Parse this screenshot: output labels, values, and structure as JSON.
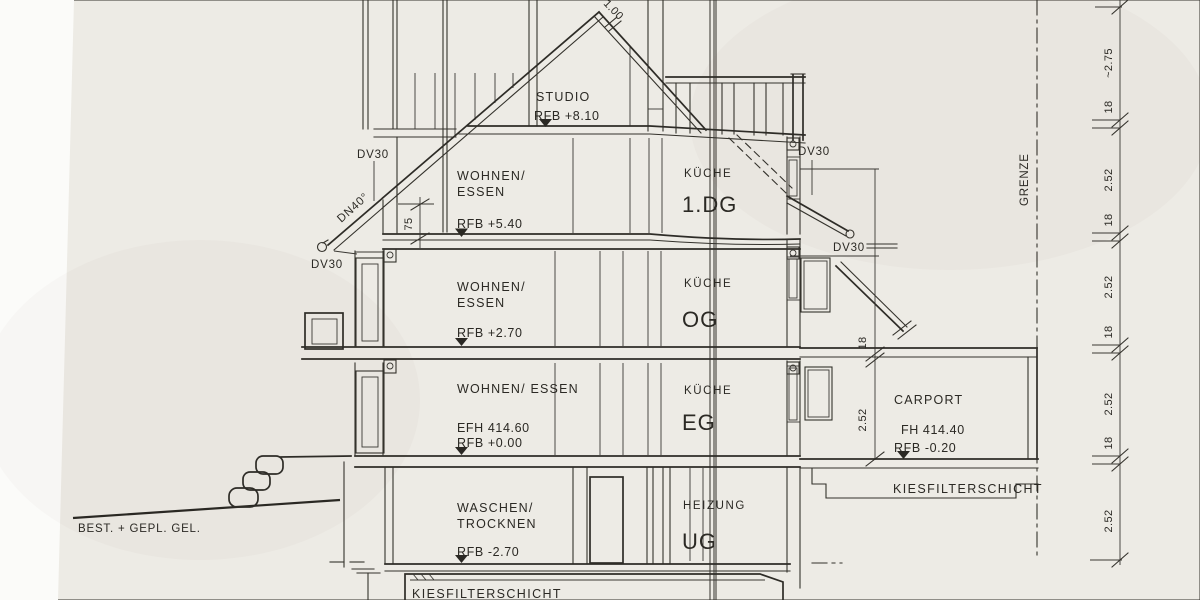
{
  "floors": {
    "studio": {
      "name": "STUDIO",
      "level": "RFB +8.10"
    },
    "dg1": {
      "left1": "WOHNEN/",
      "left2": "ESSEN",
      "level": "RFB +5.40",
      "right": "KÜCHE",
      "code": "1.DG"
    },
    "og": {
      "left1": "WOHNEN/",
      "left2": "ESSEN",
      "level": "RFB +2.70",
      "right": "KÜCHE",
      "code": "OG"
    },
    "eg": {
      "left": "WOHNEN/ ESSEN",
      "alt": "EFH 414.60",
      "level": "RFB +0.00",
      "right": "KÜCHE",
      "code": "EG"
    },
    "ug": {
      "left1": "WASCHEN/",
      "left2": "TROCKNEN",
      "level": "RFB -2.70",
      "right": "HEIZUNG",
      "code": "UG"
    },
    "foundation": "KIESFILTERSCHICHT"
  },
  "carport": {
    "name": "CARPORT",
    "alt": "FH 414.40",
    "level": "RFB -0.20",
    "foundation": "KIESFILTERSCHICHT",
    "slab_dim": "18",
    "height_dim": "2.52"
  },
  "site": {
    "terrain": "BEST. + GEPL. GEL.",
    "boundary": "GRENZE"
  },
  "annotations": {
    "dv30_left_top": "DV30",
    "dv30_left_mid": "DV30",
    "dv30_right_top": "DV30",
    "dv30_right_mid": "DV30",
    "dn": "DN40°",
    "ridge": "1.00",
    "knee": "75"
  },
  "dim_chain": [
    "~2.75",
    "18",
    "2.52",
    "18",
    "2.52",
    "18",
    "2.52",
    "18",
    "2.52"
  ]
}
